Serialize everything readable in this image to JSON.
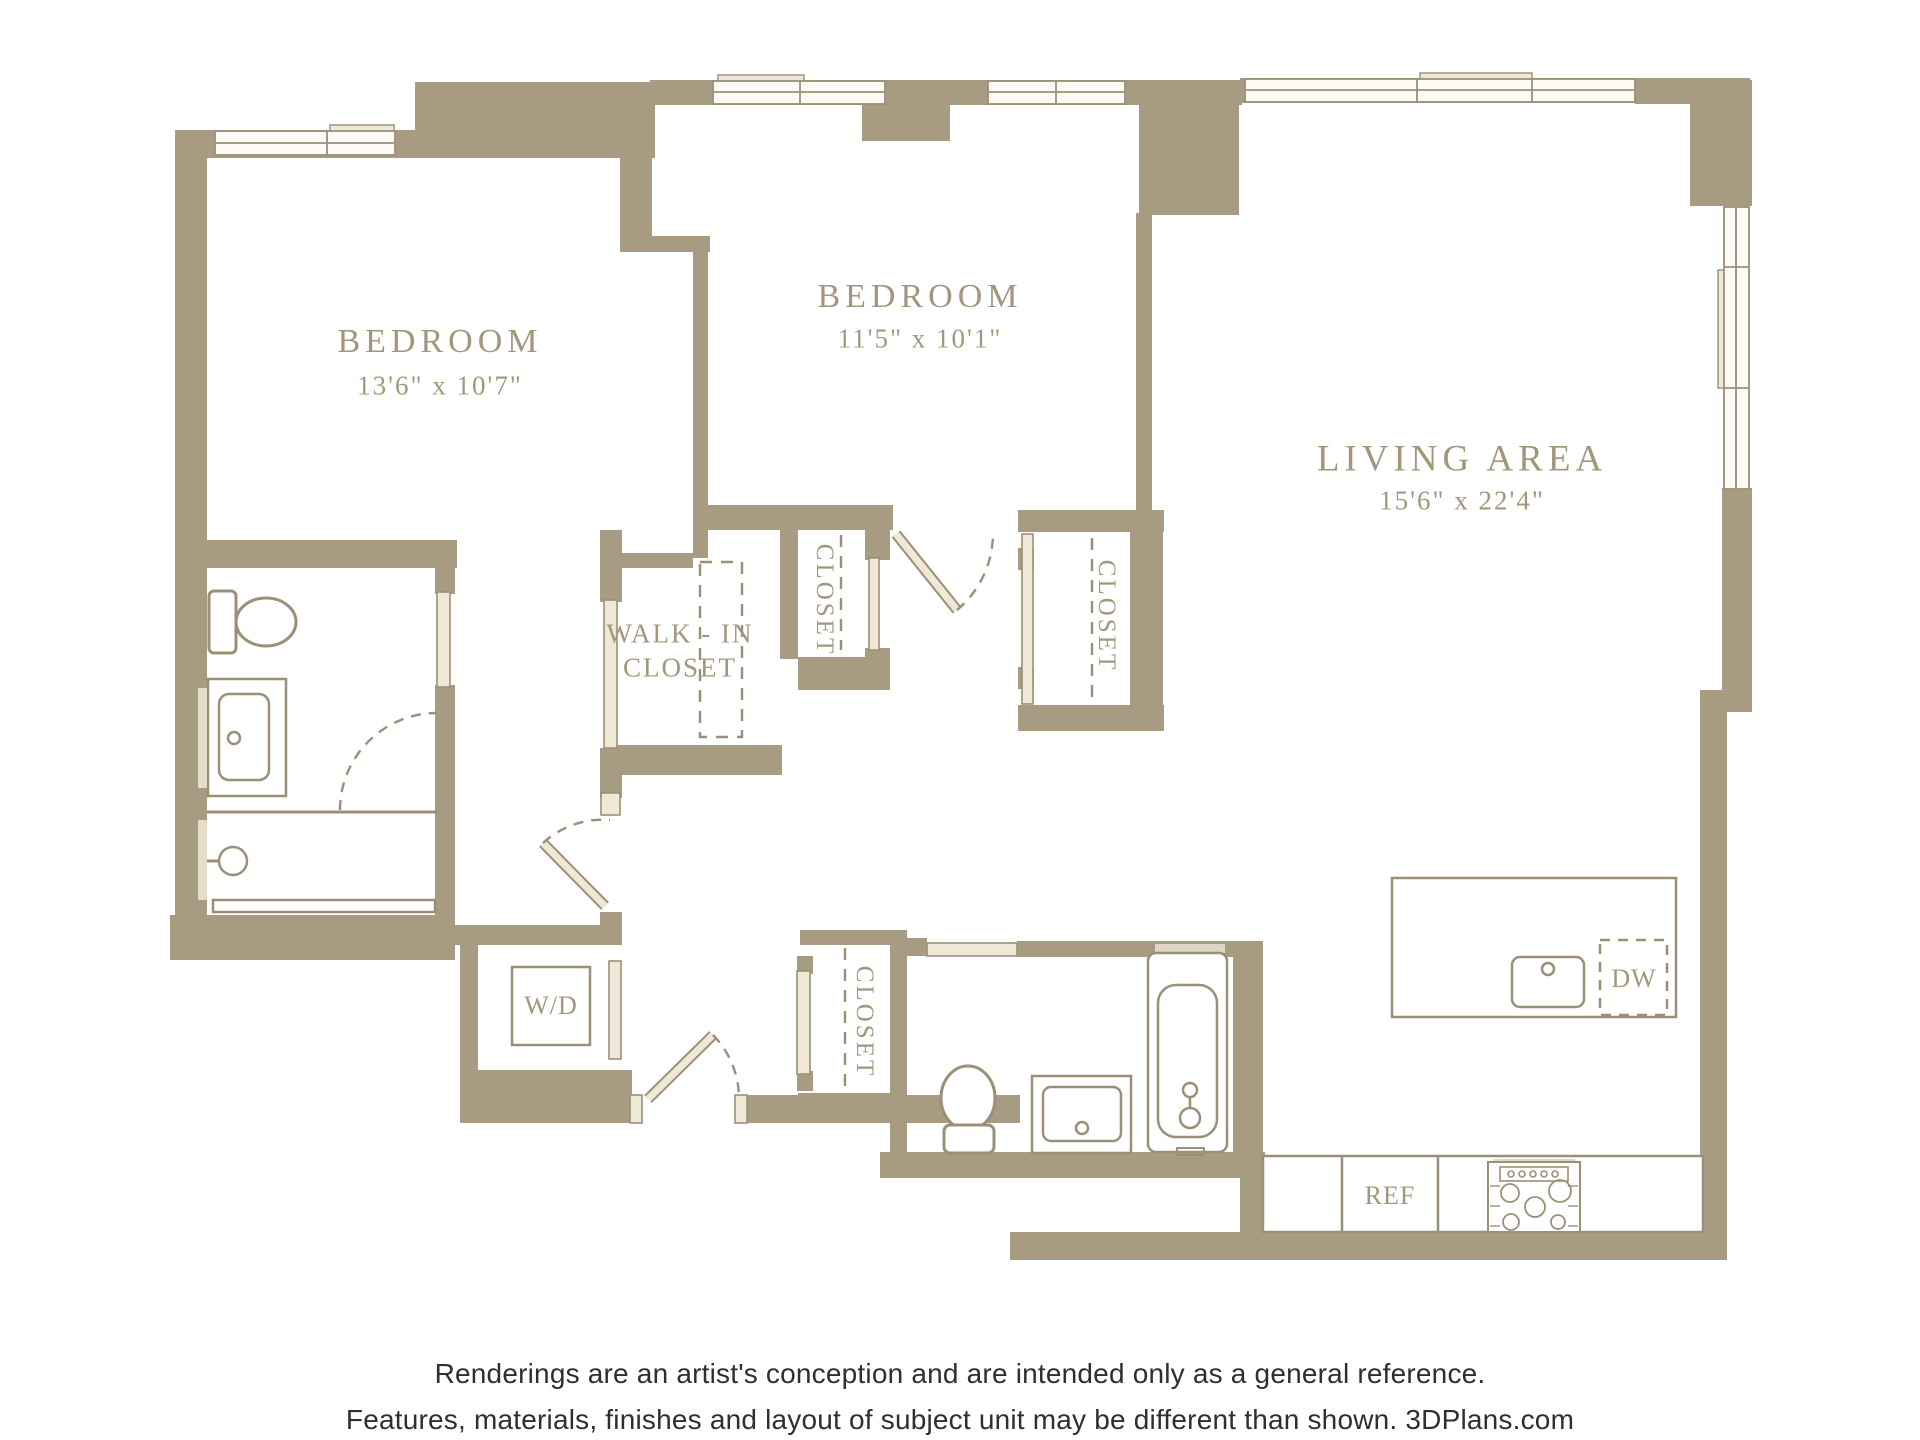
{
  "rooms": {
    "bedroom1": {
      "name": "BEDROOM",
      "dims": "13'6\" x 10'7\""
    },
    "bedroom2": {
      "name": "BEDROOM",
      "dims": "11'5\" x 10'1\""
    },
    "living_area": {
      "name": "LIVING AREA",
      "dims": "15'6\" x 22'4\""
    },
    "walk_in_closet": {
      "line1": "WALK - IN",
      "line2": "CLOSET"
    },
    "closet_upper_left": "CLOSET",
    "closet_upper_right": "CLOSET",
    "closet_entry": "CLOSET"
  },
  "appliances": {
    "washer_dryer": "W/D",
    "dishwasher": "DW",
    "refrigerator": "REF"
  },
  "footer": {
    "line1": "Renderings are an artist's conception and are intended only as a general reference.",
    "line2": "Features, materials, finishes and layout of subject unit may be different than shown. 3DPlans.com"
  },
  "colors": {
    "wall": "#a79c81",
    "fixture_outline": "#9b9077",
    "window_fill": "#fdfbf5",
    "sill_fill": "#efe8d8",
    "door_fill": "#efe8d6",
    "label_text": "#a2977b",
    "footer_text": "#2f2f2f",
    "background": "#ffffff"
  }
}
